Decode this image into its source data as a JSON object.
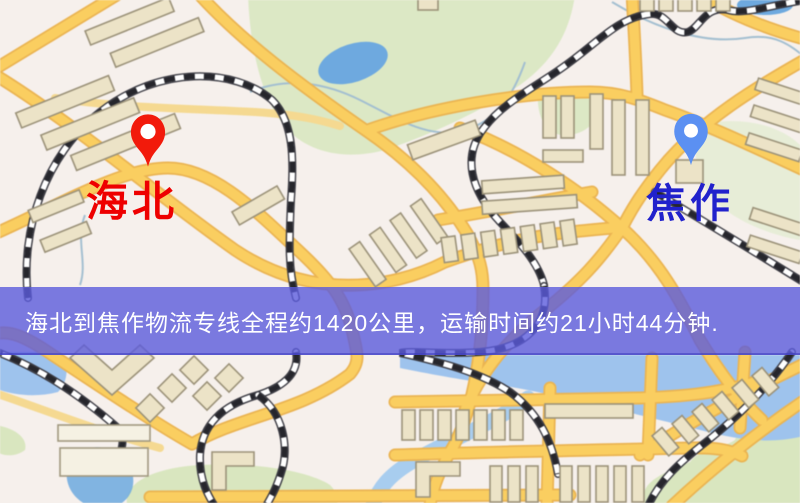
{
  "page": {
    "width": 800,
    "height": 503,
    "kind": "logistics-route-map"
  },
  "banner": {
    "text": "海北到焦作物流专线全程约1420公里，运输时间约21小时44分钟.",
    "bg_color": "#5b5bdccc",
    "text_color": "#ffffff"
  },
  "route_info": {
    "origin": "海北",
    "destination": "焦作",
    "distance_text": "约1420公里",
    "duration_text": "约21小时44分钟"
  },
  "markers": {
    "origin": {
      "name": "海北",
      "pin_color": "#f21a0b",
      "label_color": "#ee0000",
      "pin_style": "red-map-pin"
    },
    "destination": {
      "name": "焦作",
      "pin_color": "#5b90f2",
      "label_color": "#2121cc",
      "pin_style": "blue-map-pin"
    }
  },
  "map": {
    "colors": {
      "background": "#f6f0ec",
      "road": "#f9ce63",
      "road_border": "#e9b455",
      "building": "#ece3c8",
      "park": "#dce8c6",
      "water": "#6fa9dd",
      "railway": "#26262c"
    }
  }
}
